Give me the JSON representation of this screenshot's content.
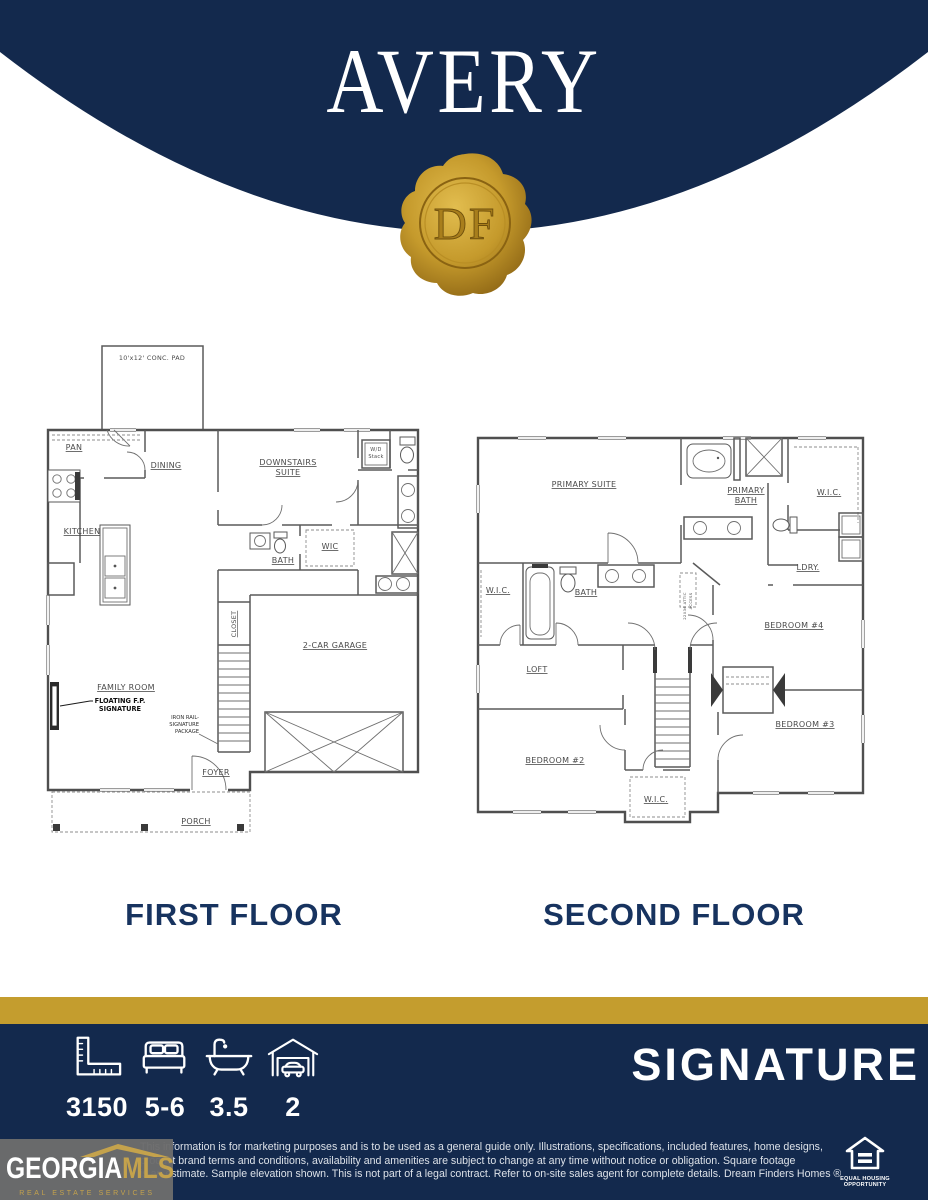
{
  "header": {
    "plan_name": "AVERY",
    "seal_monogram": "DF",
    "navy": "#13294D",
    "gold": "#C49D2E"
  },
  "first_floor": {
    "title": "FIRST FLOOR",
    "labels": {
      "conc_pad": "10'x12' CONC. PAD",
      "pan": "PAN",
      "dining": "DINING",
      "downstairs_suite_line1": "DOWNSTAIRS",
      "downstairs_suite_line2": "SUITE",
      "wd_line1": "W/D",
      "wd_line2": "Stack",
      "kitchen": "KITCHEN",
      "bath": "BATH",
      "wic": "WIC",
      "closet": "CLOSET",
      "family_room": "FAMILY ROOM",
      "floating_fp_line1": "FLOATING F.P.",
      "floating_fp_line2": "SIGNATURE",
      "iron_rail_line1": "IRON RAIL-",
      "iron_rail_line2": "SIGNATURE",
      "iron_rail_line3": "PACKAGE",
      "garage": "2-CAR GARAGE",
      "foyer": "FOYER",
      "porch": "PORCH"
    }
  },
  "second_floor": {
    "title": "SECOND FLOOR",
    "labels": {
      "primary_suite": "PRIMARY SUITE",
      "primary_bath_line1": "PRIMARY",
      "primary_bath_line2": "BATH",
      "wic_right": "W.I.C.",
      "ldry": "LDRY.",
      "wic_left": "W.I.C.",
      "bath": "BATH",
      "attic_line1": "22X36 ATTIC",
      "attic_line2": "ACCESS",
      "bedroom4": "BEDROOM #4",
      "bedroom3": "BEDROOM #3",
      "bedroom2": "BEDROOM #2",
      "loft": "LOFT",
      "wic_bottom": "W.I.C."
    }
  },
  "footer": {
    "series_name": "SIGNATURE",
    "stats": [
      {
        "icon": "ruler-icon",
        "value": "3150"
      },
      {
        "icon": "bed-icon",
        "value": "5-6"
      },
      {
        "icon": "bathtub-icon",
        "value": "3.5"
      },
      {
        "icon": "garage-icon",
        "value": "2"
      }
    ],
    "disclaimer_line1": "This information is for marketing purposes and is to be used as a general guide only. Illustrations, specifications, included features, home designs,",
    "disclaimer_line2": "product brand terms and conditions, availability and amenities are subject to change at any time without notice or obligation. Square footage",
    "disclaimer_line3": "is an estimate. Sample elevation shown. This is not part of a legal contract. Refer to on-site sales agent for complete details. Dream Finders Homes ®",
    "georgia_mls": {
      "name_part1": "GEORGIA",
      "name_part2": "MLS",
      "tagline": "REAL ESTATE SERVICES"
    },
    "equal_housing": {
      "line1": "EQUAL HOUSING",
      "line2": "OPPORTUNITY"
    }
  }
}
